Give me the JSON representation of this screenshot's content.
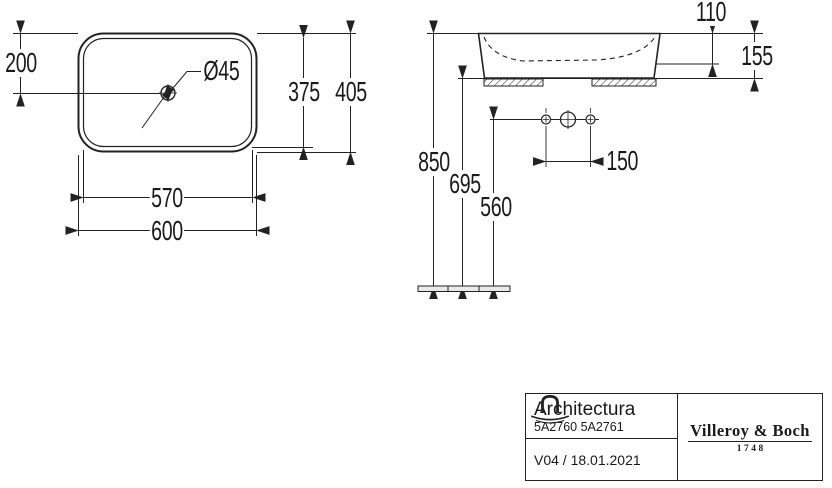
{
  "views": {
    "plan": {
      "labels": {
        "offset": "200",
        "drain_diameter": "Ø45",
        "inner_length": "375",
        "outer_length": "405",
        "inner_width": "570",
        "outer_width": "600"
      }
    },
    "elevation": {
      "labels": {
        "bowl_depth": "110",
        "overall_height": "155",
        "rim_height": "850",
        "underside_height": "695",
        "tap_line_height": "560",
        "hole_spacing": "150"
      }
    }
  },
  "title_block": {
    "series": "Architectura",
    "article_numbers": "5A2760 5A2761",
    "revision": "V04 / 18.01.2021",
    "brand": "Villeroy & Boch",
    "founded": "1748"
  },
  "colors": {
    "line": "#222222",
    "text": "#1a1a1a",
    "background": "#ffffff"
  }
}
